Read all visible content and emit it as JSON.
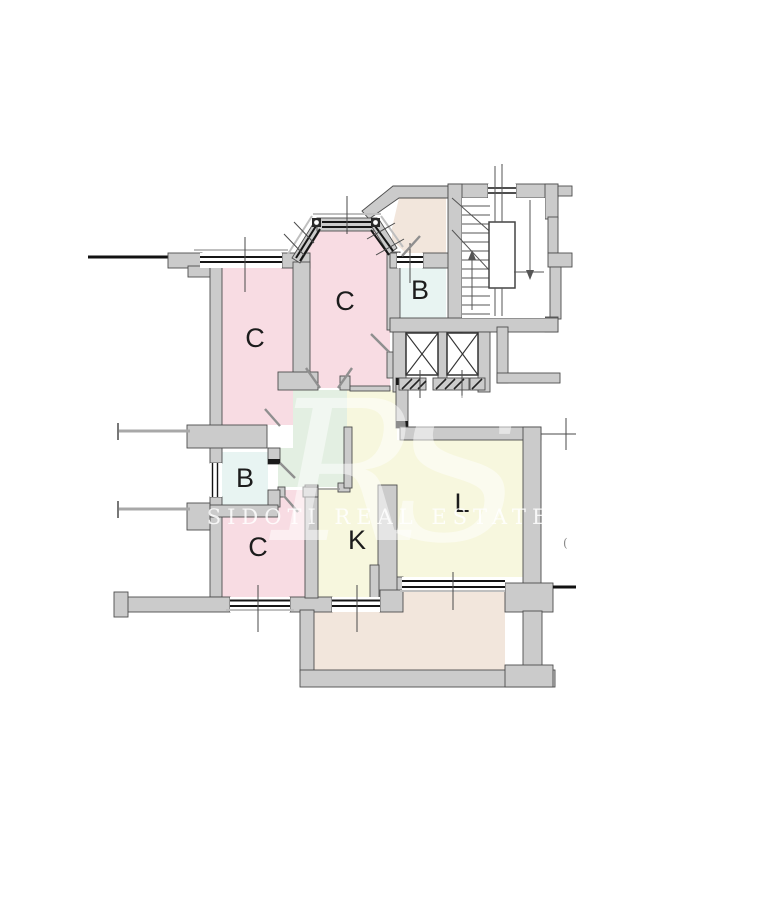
{
  "floorplan": {
    "rooms": [
      {
        "id": "room-c-top-left",
        "label": "C",
        "color": "#f8dce3"
      },
      {
        "id": "room-c-top-middle",
        "label": "C",
        "color": "#f8dce3"
      },
      {
        "id": "room-b-top",
        "label": "B",
        "color": "#e8f4f2"
      },
      {
        "id": "room-b-bottom",
        "label": "B",
        "color": "#e8f4f2"
      },
      {
        "id": "room-c-bottom",
        "label": "C",
        "color": "#f8dce3"
      },
      {
        "id": "room-k",
        "label": "K",
        "color": "#f7f7de"
      },
      {
        "id": "room-l",
        "label": "L",
        "color": "#f7f7de"
      }
    ],
    "zones": {
      "hallway_color": "#e3efe2",
      "corridor_color": "#f7f7de",
      "balcony_color": "#f2e6dc",
      "vestibule_color": "#f2e6dc",
      "wall_color": "#cbcbcb",
      "wall_outline": "#4d4d4d"
    },
    "watermark": {
      "monogram": "RS",
      "brand": "SIDOTI REAL ESTATE"
    },
    "stray_mark": "("
  }
}
